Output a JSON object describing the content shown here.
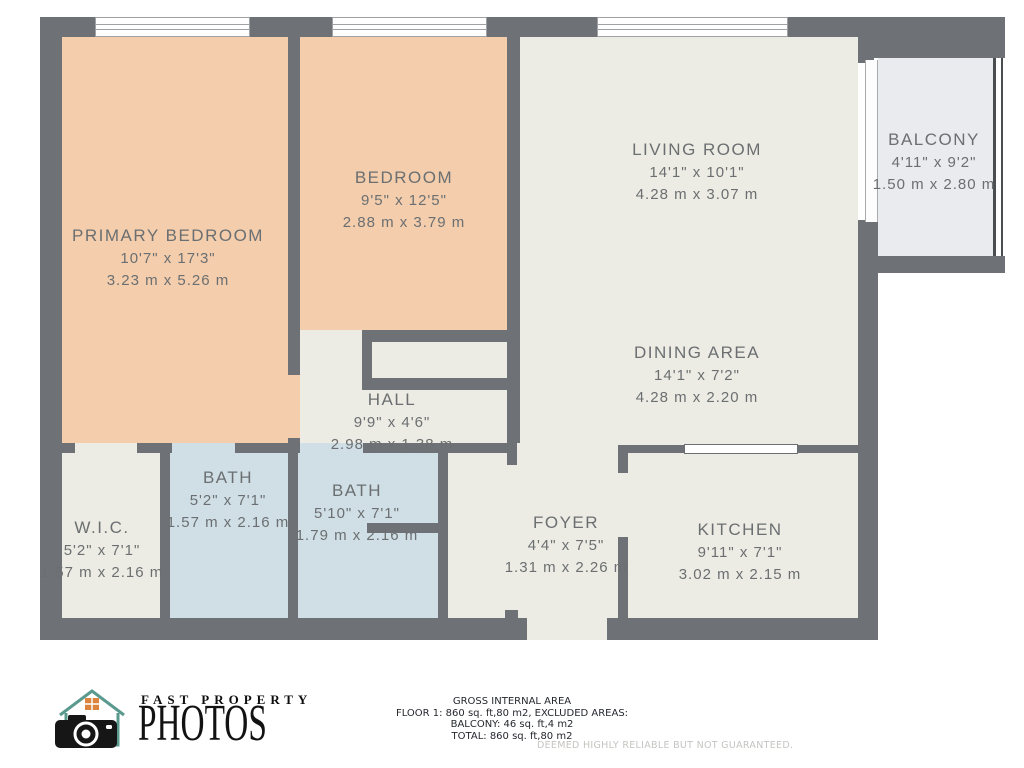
{
  "rooms": {
    "primary_bedroom": {
      "name": "PRIMARY BEDROOM",
      "dims_ft": "10'7\" x 17'3\"",
      "dims_m": "3.23 m x 5.26 m"
    },
    "bedroom": {
      "name": "BEDROOM",
      "dims_ft": "9'5\" x 12'5\"",
      "dims_m": "2.88 m x 3.79 m"
    },
    "living_room": {
      "name": "LIVING ROOM",
      "dims_ft": "14'1\" x 10'1\"",
      "dims_m": "4.28 m x 3.07 m"
    },
    "balcony": {
      "name": "BALCONY",
      "dims_ft": "4'11\" x 9'2\"",
      "dims_m": "1.50 m x 2.80 m"
    },
    "dining_area": {
      "name": "DINING AREA",
      "dims_ft": "14'1\" x 7'2\"",
      "dims_m": "4.28 m x 2.20 m"
    },
    "hall": {
      "name": "HALL",
      "dims_ft": "9'9\" x 4'6\"",
      "dims_m": "2.98 m x 1.38 m"
    },
    "wic": {
      "name": "W.I.C.",
      "dims_ft": "5'2\" x 7'1\"",
      "dims_m": "1.57 m x 2.16 m"
    },
    "bath_1": {
      "name": "BATH",
      "dims_ft": "5'2\" x 7'1\"",
      "dims_m": "1.57 m x 2.16 m"
    },
    "bath_2": {
      "name": "BATH",
      "dims_ft": "5'10\" x 7'1\"",
      "dims_m": "1.79 m x 2.16 m"
    },
    "foyer": {
      "name": "FOYER",
      "dims_ft": "4'4\" x 7'5\"",
      "dims_m": "1.31 m x 2.26 m"
    },
    "kitchen": {
      "name": "KITCHEN",
      "dims_ft": "9'11\" x 7'1\"",
      "dims_m": "3.02 m x 2.15 m"
    }
  },
  "branding": {
    "line1": "FAST PROPERTY",
    "line2": "PHOTOS"
  },
  "summary": {
    "line1": "GROSS INTERNAL AREA",
    "line2": "FLOOR 1: 860 sq. ft,80 m2, EXCLUDED AREAS:",
    "line3": "BALCONY: 46 sq. ft,4 m2",
    "line4": "TOTAL: 860 sq. ft,80 m2",
    "disclaimer": "DEEMED HIGHLY RELIABLE BUT NOT GUARANTEED."
  },
  "colors": {
    "wall": "#6e7276",
    "bedroom_fill": "#f3cdac",
    "room_fill": "#edece4",
    "bath_fill": "#cfdfe5",
    "balcony_fill": "#e9ebee",
    "label_text": "#6b6f71",
    "logo_teal": "#5a998d",
    "logo_orange": "#dd853f"
  }
}
